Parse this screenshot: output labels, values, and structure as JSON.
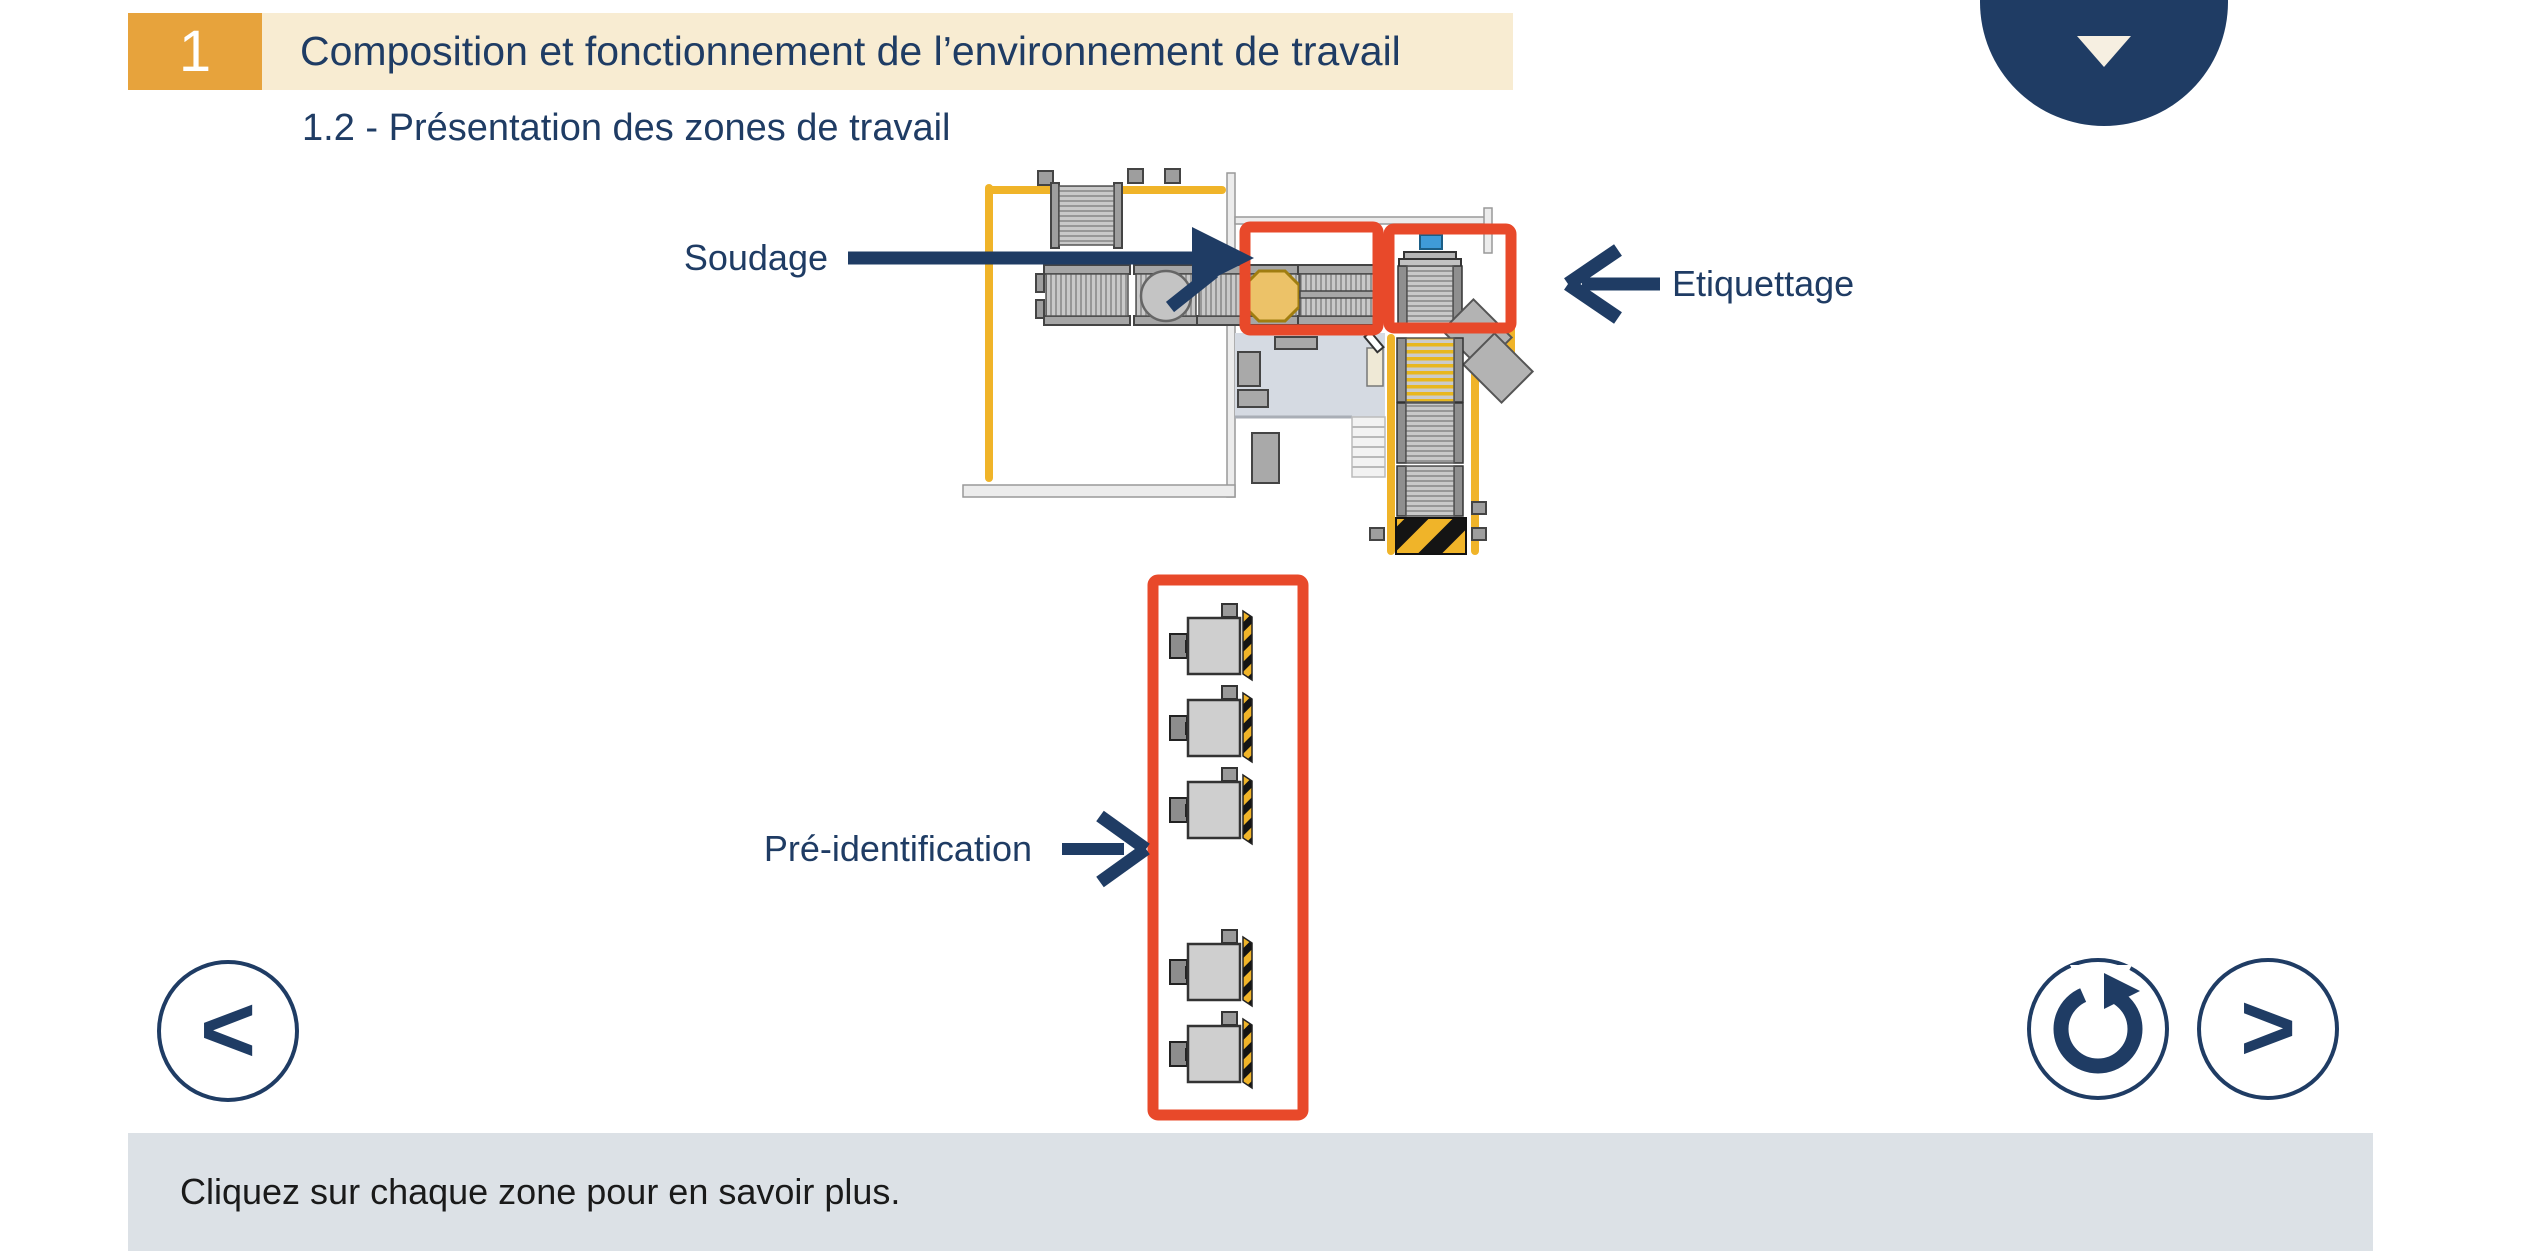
{
  "header": {
    "unit_number": "1",
    "title": "Composition et fonctionnement de l’environnement de travail",
    "subtitle": "1.2 - Présentation des zones de travail"
  },
  "diagram": {
    "zone_labels": {
      "soudage": "Soudage",
      "etiquettage": "Etiquettage",
      "pre_identification": "Pré-identification"
    }
  },
  "footer": {
    "instruction": "Cliquez sur chaque zone pour en savoir plus."
  },
  "nav": {
    "prev_label": "<",
    "next_label": ">",
    "replay_icon": "circular-arrow",
    "menu_icon": "chevron-down",
    "captions_icon": "speech-bubble-crossed"
  },
  "colors": {
    "navy": "#1f3c64",
    "header_orange": "#e7a33c",
    "header_beige": "#f8ecd2",
    "zone_red": "#e8492a",
    "footer_bg": "#dce1e6",
    "rail_yellow": "#f0b429",
    "welding_octagon": "#ecc268",
    "info_blue": "#3f9bd8"
  }
}
